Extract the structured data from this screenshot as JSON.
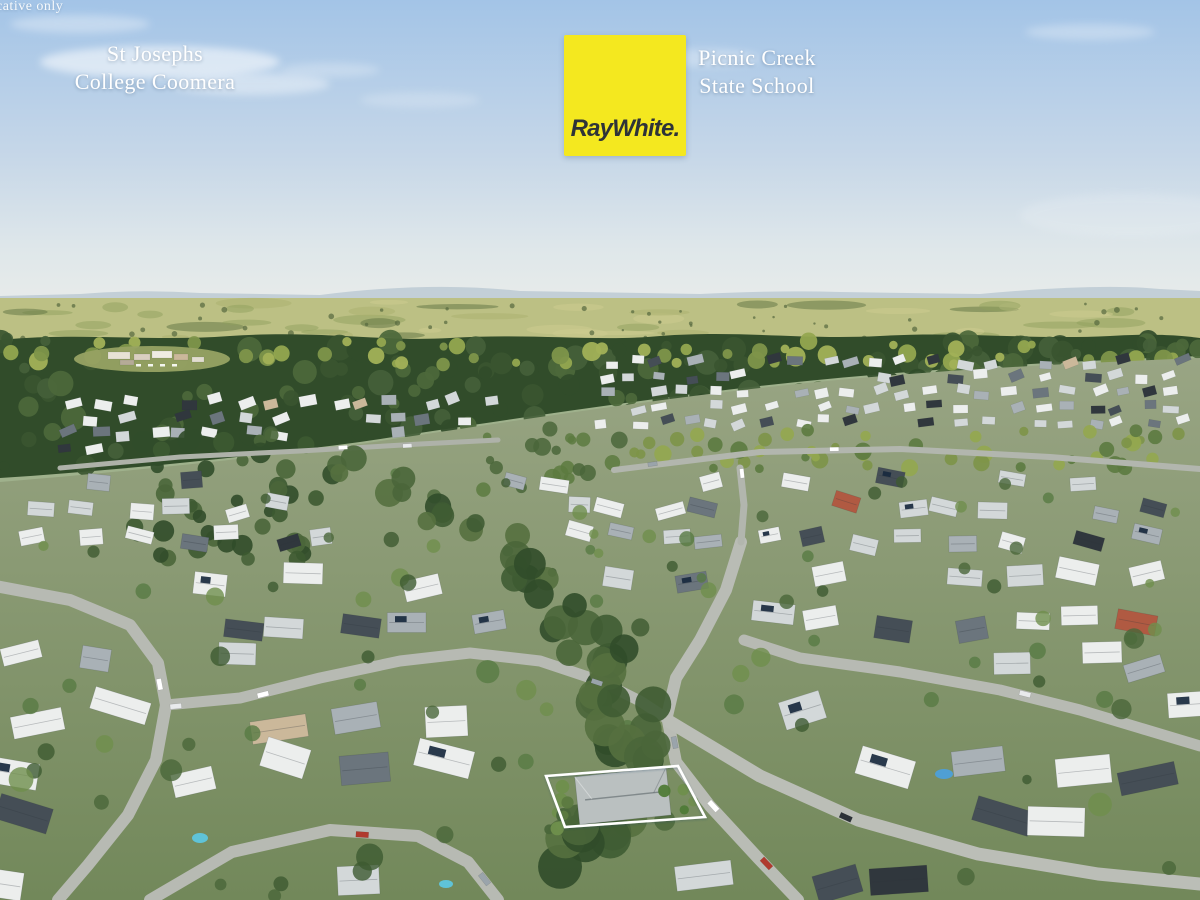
{
  "watermark": {
    "text": "cative only"
  },
  "branding": {
    "logo_text": "RayWhite.",
    "logo_background": "#f4e81f",
    "logo_text_color": "#2e3338"
  },
  "annotations": {
    "line_color": "#ffffff",
    "landmarks": [
      {
        "name": "St Josephs College Coomera",
        "lines": [
          "St Josephs",
          "College Coomera"
        ]
      },
      {
        "name": "Picnic Creek State School",
        "lines": [
          "Picnic Creek",
          "State School"
        ]
      }
    ],
    "highlighted_property": {
      "outline_color": "#ffffff"
    }
  },
  "scene": {
    "description": "Aerial drone photograph of a residential suburb surrounded by forest with distant hills and hazy horizon; a Ray White signboard and white leader lines mark a highlighted property and two nearby schools",
    "palette": {
      "sky_top": "#a3c4e7",
      "sky_mid": "#c6d7e8",
      "sky_low": "#dfe7ea",
      "sky_horizon": "#e9ecea",
      "hills": "#b3c3cf",
      "field": "#bcc084",
      "forest_dark": "#314c2a",
      "forest_mid": "#4c683b",
      "forest_sunlit": "#93a74f",
      "lawn_top": "#99a584",
      "lawn_bottom": "#72885a",
      "road": "#b7bab3",
      "roof_white": "#eceeed",
      "roof_light": "#d3d8d9",
      "roof_mid": "#a9b1b6",
      "roof_slate": "#6b757d",
      "roof_dark": "#454e56",
      "roof_charcoal": "#30373d",
      "roof_terracotta": "#b05a42",
      "roof_tan": "#cbb89a",
      "solar_panel": "#18293e",
      "tree_green": "#4a663a",
      "pool_blue": "#5fc3d8"
    }
  }
}
